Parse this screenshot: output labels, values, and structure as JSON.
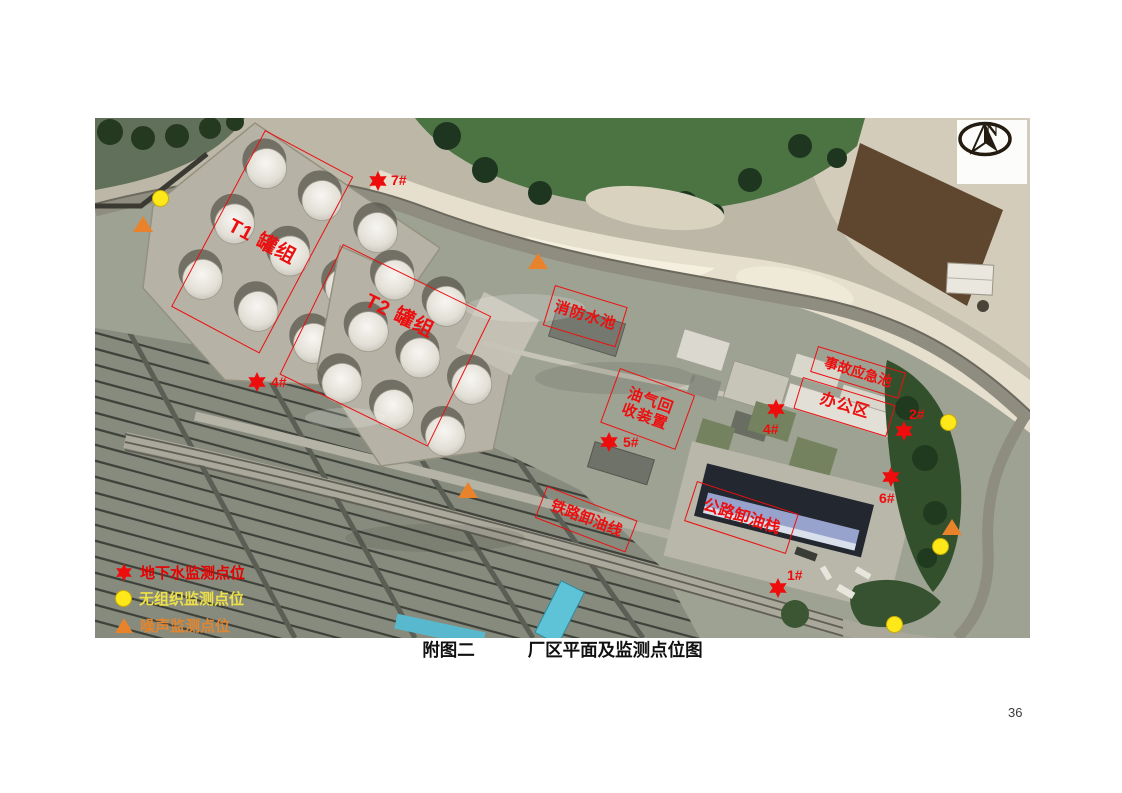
{
  "page": {
    "number": "36"
  },
  "caption": {
    "figure_label": "附图二",
    "title": "厂区平面及监测点位图"
  },
  "compass": {
    "north_label": "N"
  },
  "map": {
    "area_labels": {
      "t1": "T1 罐组",
      "t2": "T2 罐组",
      "fire_pool": "消防水池",
      "vapor_recovery_line1": "油气回",
      "vapor_recovery_line2": "收装置",
      "emergency_pool": "事故应急池",
      "office": "办公区",
      "rail_unloading": "铁路卸油线",
      "road_unloading": "公路卸油栈"
    },
    "monitoring_points": {
      "groundwater": [
        {
          "label": "7#"
        },
        {
          "label": "4#"
        },
        {
          "label": "5#"
        },
        {
          "label": "4#"
        },
        {
          "label": "2#"
        },
        {
          "label": "6#"
        },
        {
          "label": "1#"
        }
      ]
    }
  },
  "legend": {
    "items": [
      {
        "symbol": "red-star",
        "label": "地下水监测点位",
        "color": "#e60000"
      },
      {
        "symbol": "yellow-circle",
        "label": "无组织监测点位",
        "color": "#eee046"
      },
      {
        "symbol": "orange-triangle",
        "label": "噪声监测点位",
        "color": "#e2852e"
      }
    ]
  },
  "colors": {
    "annotation_red": "#ee1111",
    "marker_yellow": "#ffe819",
    "marker_orange": "#e8832c"
  }
}
